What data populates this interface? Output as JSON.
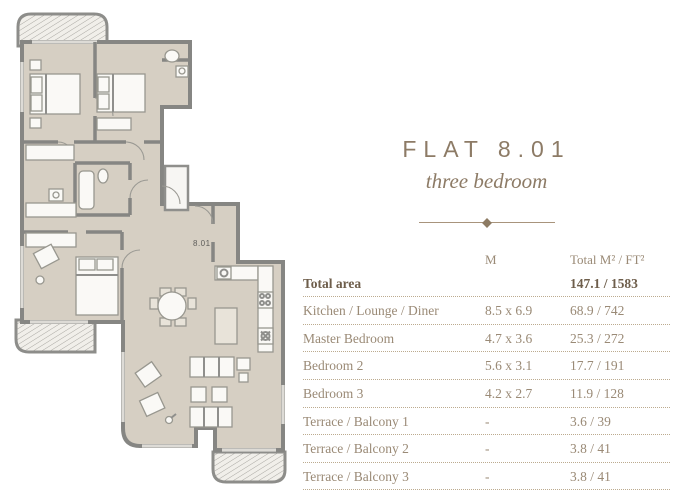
{
  "header": {
    "title": "FLAT 8.01",
    "subtitle": "three bedroom"
  },
  "plan": {
    "unit_label": "8.01"
  },
  "table": {
    "header": {
      "label": "",
      "dims": "M",
      "area": "Total M² / FT²"
    },
    "rows": [
      {
        "label": "Total area",
        "dims": "",
        "area": "147.1 / 1583",
        "bold": true
      },
      {
        "label": "Kitchen / Lounge / Diner",
        "dims": "8.5 x 6.9",
        "area": "68.9 / 742",
        "bold": false
      },
      {
        "label": "Master Bedroom",
        "dims": "4.7 x 3.6",
        "area": "25.3 / 272",
        "bold": false
      },
      {
        "label": "Bedroom 2",
        "dims": "5.6 x 3.1",
        "area": "17.7 / 191",
        "bold": false
      },
      {
        "label": "Bedroom 3",
        "dims": "4.2 x 2.7",
        "area": "11.9 / 128",
        "bold": false
      },
      {
        "label": "Terrace / Balcony 1",
        "dims": "-",
        "area": "3.6 / 39",
        "bold": false
      },
      {
        "label": "Terrace / Balcony 2",
        "dims": "-",
        "area": "3.8 / 41",
        "bold": false
      },
      {
        "label": "Terrace / Balcony 3",
        "dims": "-",
        "area": "3.8 / 41",
        "bold": false
      }
    ]
  },
  "colors": {
    "text_brown": "#9a8a76",
    "text_dark_brown": "#6e5e4b",
    "floor_beige": "#d6cfc3",
    "wall_gray": "#868683",
    "divider_brown": "#a8947c"
  }
}
